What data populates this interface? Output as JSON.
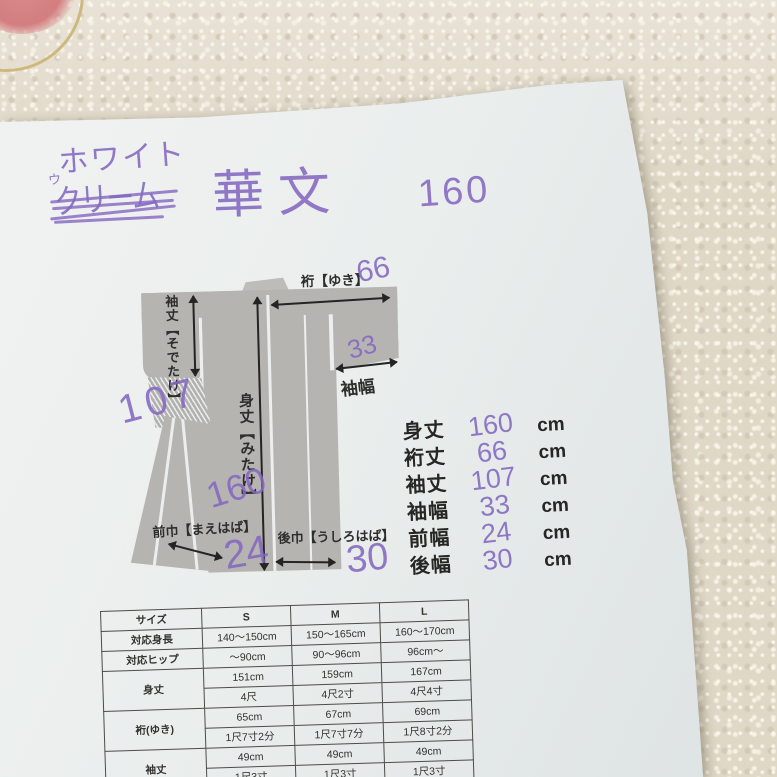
{
  "handwriting": {
    "color_note": "ホワイト",
    "crossed_prefix": "ウ",
    "crossed_word": "クリーム",
    "pattern_name": "華文",
    "height_note": "160"
  },
  "diagram": {
    "labels": {
      "yuki": "裄【ゆき】",
      "sodetake": "袖丈【そでたけ】",
      "mitake": "身丈【みたけ】",
      "sodehaba": "袖幅",
      "maehaba": "前巾【まえはば】",
      "ushirohaba": "後巾【うしろはば】"
    },
    "handwritten_values": {
      "yuki": "66",
      "sodehaba": "33",
      "sodetake": "107",
      "mitake": "160",
      "maehaba": "24",
      "ushirohaba": "30"
    }
  },
  "measurements": {
    "unit": "cm",
    "items": [
      {
        "label": "身丈",
        "value": "160"
      },
      {
        "label": "裄丈",
        "value": "66"
      },
      {
        "label": "袖丈",
        "value": "107"
      },
      {
        "label": "袖幅",
        "value": "33"
      },
      {
        "label": "前幅",
        "value": "24"
      },
      {
        "label": "後幅",
        "value": "30"
      }
    ]
  },
  "size_table": {
    "headers": [
      "サイズ",
      "S",
      "M",
      "L"
    ],
    "rows": [
      {
        "label": "対応身長",
        "values": [
          "140～150cm",
          "150～165cm",
          "160～170cm"
        ]
      },
      {
        "label": "対応ヒップ",
        "values": [
          "～90cm",
          "90～96cm",
          "96cm～"
        ]
      },
      {
        "label": "身丈",
        "values": [
          "151cm",
          "159cm",
          "167cm"
        ],
        "values2": [
          "4尺",
          "4尺2寸",
          "4尺4寸"
        ]
      },
      {
        "label": "裄(ゆき)",
        "values": [
          "65cm",
          "67cm",
          "69cm"
        ],
        "values2": [
          "1尺7寸2分",
          "1尺7寸7分",
          "1尺8寸2分"
        ]
      },
      {
        "label": "袖丈",
        "values": [
          "49cm",
          "49cm",
          "49cm"
        ],
        "values2": [
          "1尺3寸",
          "1尺3寸",
          "1尺3寸"
        ]
      }
    ]
  },
  "colors": {
    "paper": "#eaeeed",
    "fabric": "#e0d8c7",
    "diagram_gray": "#b5b4b1",
    "print_ink": "#2e2e2c",
    "pen_purple": "#8466c0",
    "motif_pink": "#d5878b",
    "motif_gold": "#cdb97e"
  }
}
